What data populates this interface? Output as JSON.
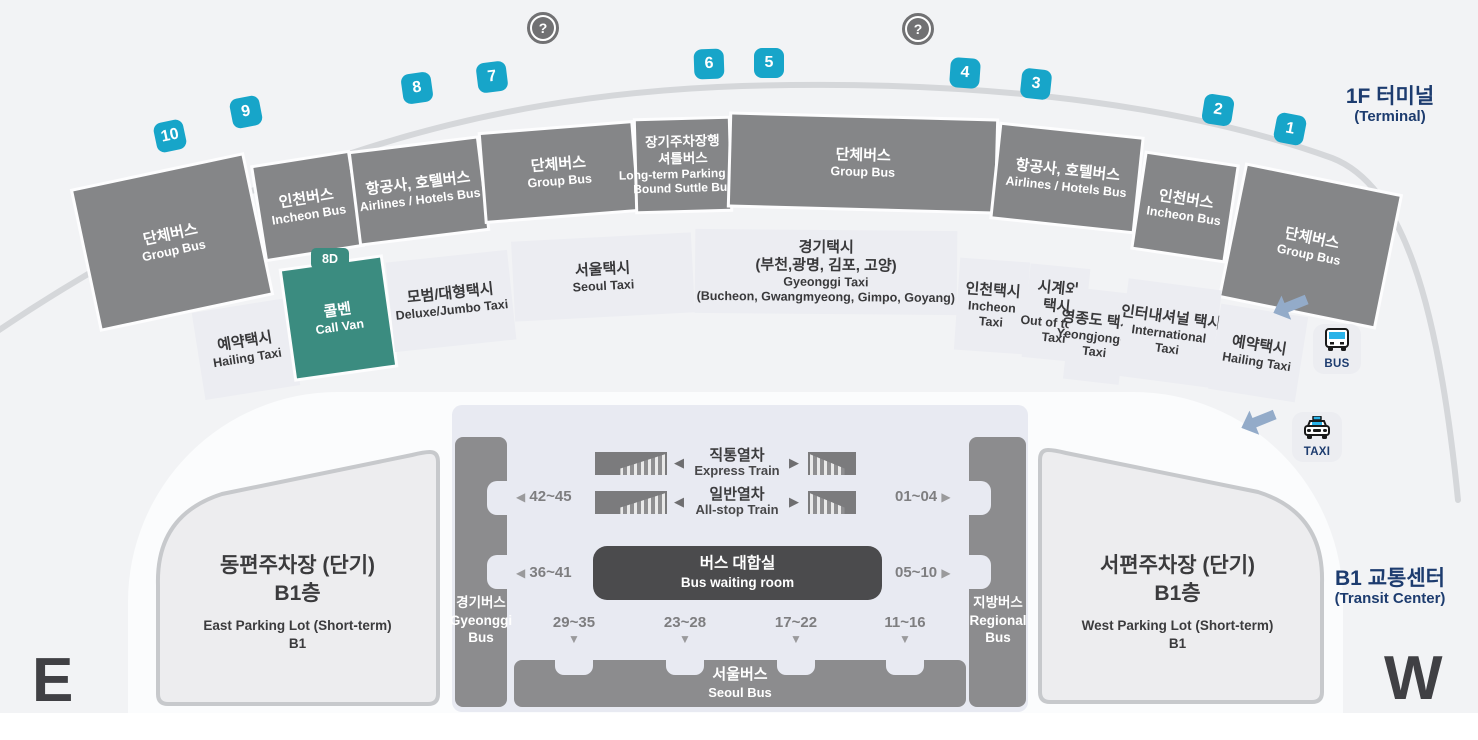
{
  "page": {
    "terminal_title_ko": "1F 터미널",
    "terminal_title_en": "(Terminal)",
    "transit_title_ko": "B1 교통센터",
    "transit_title_en": "(Transit Center)",
    "east_letter": "E",
    "west_letter": "W"
  },
  "colors": {
    "stop_badge": "#17a5c9",
    "call_van_green": "#3b8c80",
    "segment_gray": "#858688",
    "navy_text": "#1d3c6f"
  },
  "icons": {
    "help": "?",
    "bus_label": "BUS",
    "taxi_label": "TAXI"
  },
  "stops": [
    "10",
    "9",
    "8",
    "7",
    "6",
    "5",
    "4",
    "3",
    "2",
    "1"
  ],
  "stop_gate": "8D",
  "bus_segments": [
    {
      "ko": "단체버스",
      "en": "Group Bus"
    },
    {
      "ko": "인천버스",
      "en": "Incheon Bus"
    },
    {
      "ko": "항공사, 호텔버스",
      "en": "Airlines / Hotels Bus"
    },
    {
      "ko": "단체버스",
      "en": "Group Bus"
    },
    {
      "ko": "장기주차장행",
      "ko2": "셔틀버스",
      "en": "Long-term Parking Lot",
      "en2": "Bound Suttle Bus"
    },
    {
      "ko": "단체버스",
      "en": "Group Bus"
    },
    {
      "ko": "항공사, 호텔버스",
      "en": "Airlines / Hotels Bus"
    },
    {
      "ko": "인천버스",
      "en": "Incheon Bus"
    },
    {
      "ko": "단체버스",
      "en": "Group Bus"
    }
  ],
  "taxi_segments": [
    {
      "ko": "예약택시",
      "en": "Hailing Taxi"
    },
    {
      "ko": "콜벤",
      "en": "Call Van"
    },
    {
      "ko": "모범/대형택시",
      "en": "Deluxe/Jumbo Taxi"
    },
    {
      "ko": "서울택시",
      "en": "Seoul Taxi"
    },
    {
      "ko": "경기택시",
      "ko2": "(부천,광명, 김포, 고양)",
      "en": "Gyeonggi Taxi",
      "en2": "(Bucheon, Gwangmyeong, Gimpo, Goyang)"
    },
    {
      "ko": "인천택시",
      "en": "Incheon",
      "en2": "Taxi"
    },
    {
      "ko": "시계외",
      "ko2": "택시",
      "en": "Out of town",
      "en2": "Taxi"
    },
    {
      "ko": "영종도 택시",
      "en": "Yeongjongdo",
      "en2": "Taxi"
    },
    {
      "ko": "인터내셔널 택시",
      "en": "International",
      "en2": "Taxi"
    },
    {
      "ko": "예약택시",
      "en": "Hailing Taxi"
    }
  ],
  "transit_center": {
    "express_ko": "직통열차",
    "express_en": "Express Train",
    "allstop_ko": "일반열차",
    "allstop_en": "All-stop Train",
    "waiting_ko": "버스 대합실",
    "waiting_en": "Bus waiting room",
    "left_pillar_ko": "경기버스",
    "left_pillar_en1": "Gyeonggi",
    "left_pillar_en2": "Bus",
    "right_pillar_ko": "지방버스",
    "right_pillar_en1": "Regional",
    "right_pillar_en2": "Bus",
    "seoul_ko": "서울버스",
    "seoul_en": "Seoul Bus",
    "gate_left_1": "42~45",
    "gate_left_2": "36~41",
    "gate_right_1": "01~04",
    "gate_right_2": "05~10",
    "gates_bottom": [
      "29~35",
      "23~28",
      "17~22",
      "11~16"
    ],
    "arrow_left": "◀",
    "arrow_right": "▶",
    "arrow_down": "▼"
  },
  "parking": {
    "east_ko": "동편주차장 (단기)",
    "east_ko2": "B1층",
    "east_en": "East Parking Lot (Short-term)",
    "east_en2": "B1",
    "west_ko": "서편주차장 (단기)",
    "west_ko2": "B1층",
    "west_en": "West Parking Lot (Short-term)",
    "west_en2": "B1"
  }
}
